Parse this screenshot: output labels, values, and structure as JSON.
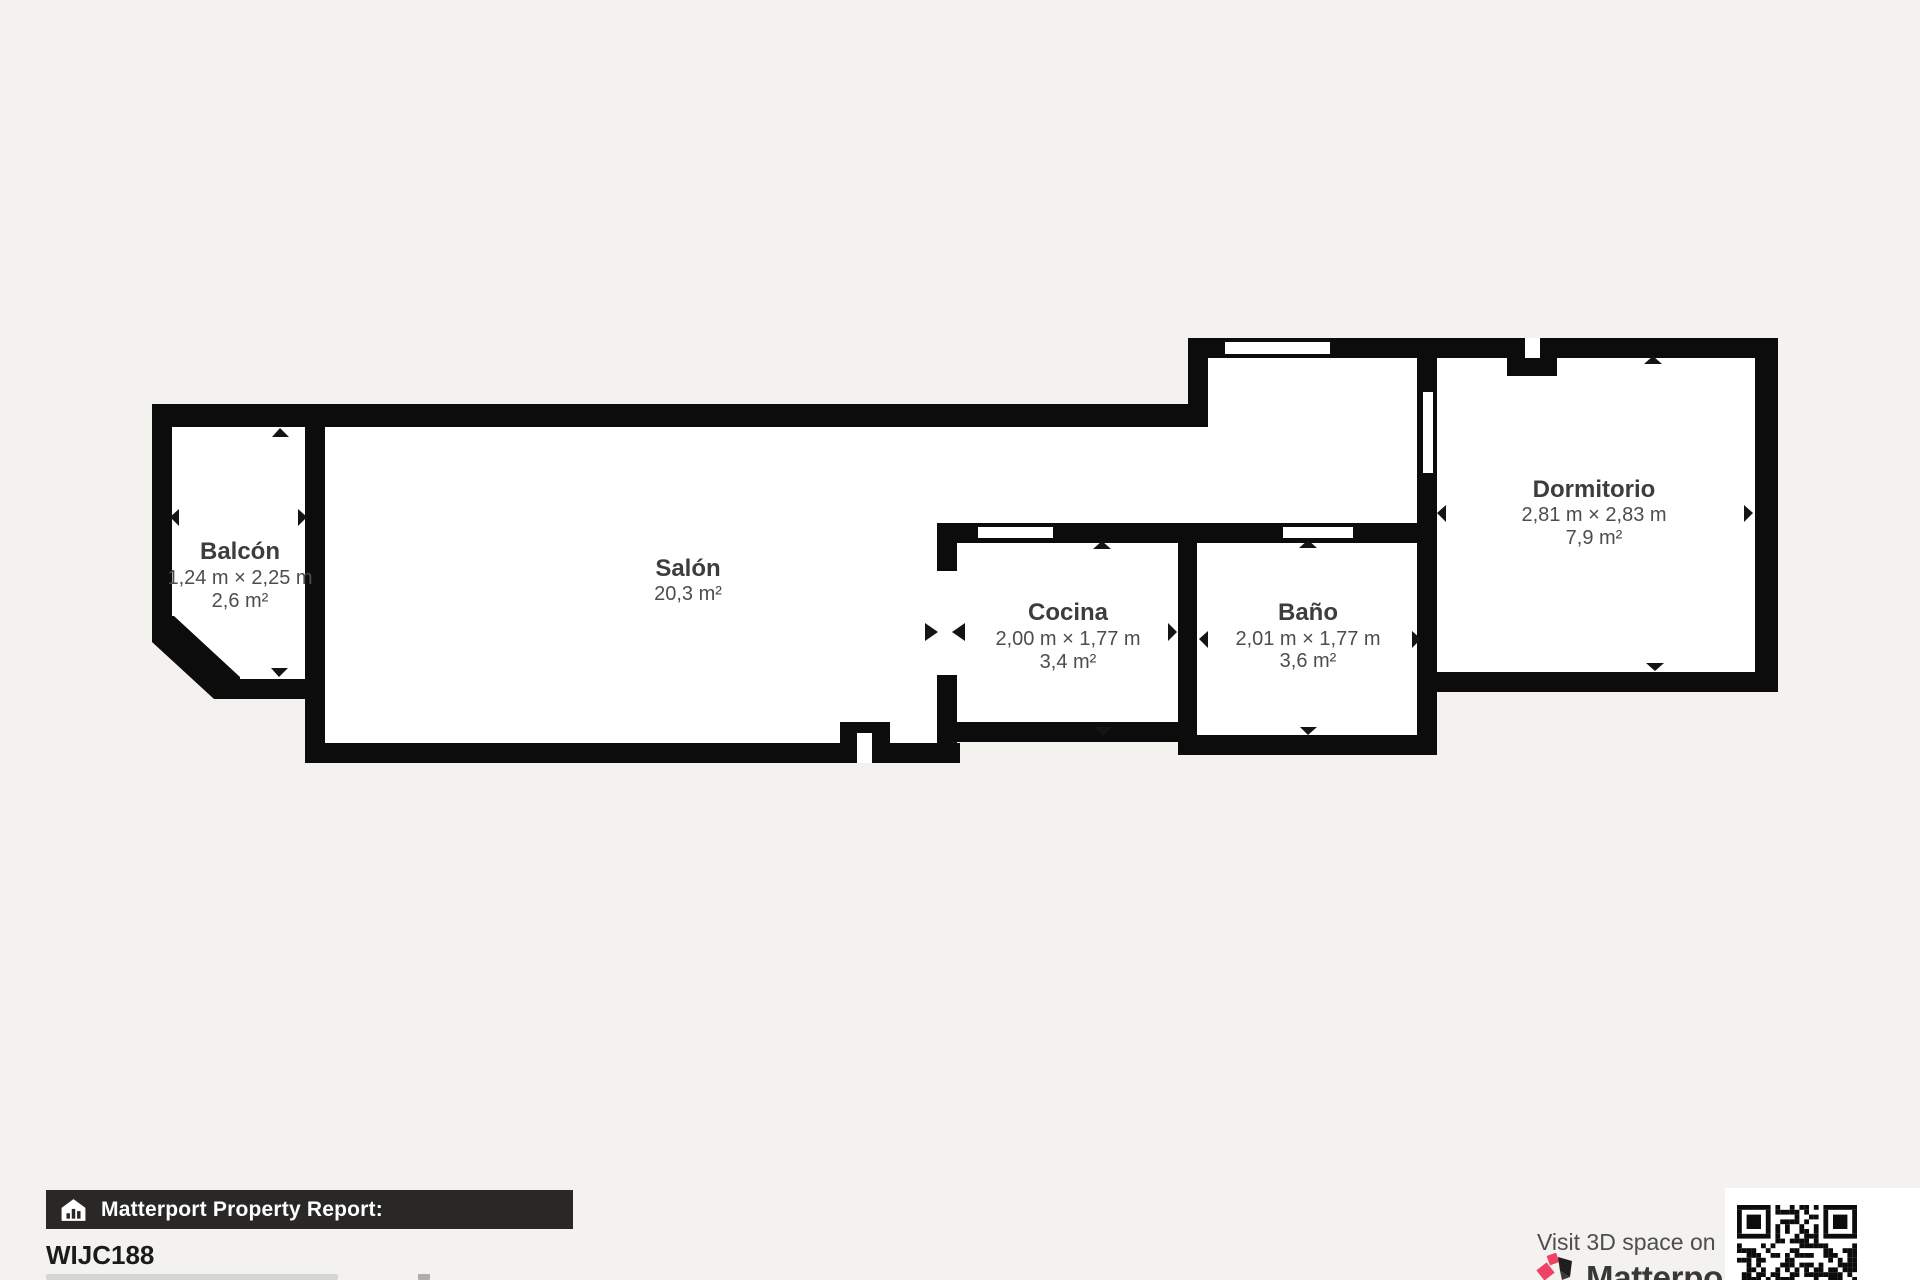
{
  "colors": {
    "background": "#f3f2ef",
    "wall": "#0c0c0c",
    "floor": "#ffffff",
    "brand_pink": "#ee4266",
    "brand_dark": "#1e1e1e",
    "banner_bg": "#292827"
  },
  "rooms": [
    {
      "id": "balcon",
      "name": "Balcón",
      "dimensions": "1,24 m × 2,25 m",
      "area": "2,6 m²"
    },
    {
      "id": "salon",
      "name": "Salón",
      "dimensions": "",
      "area": "20,3 m²"
    },
    {
      "id": "cocina",
      "name": "Cocina",
      "dimensions": "2,00 m × 1,77 m",
      "area": "3,4 m²"
    },
    {
      "id": "bano",
      "name": "Baño",
      "dimensions": "2,01 m × 1,77 m",
      "area": "3,6 m²"
    },
    {
      "id": "dormitorio",
      "name": "Dormitorio",
      "dimensions": "2,81 m × 2,83 m",
      "area": "7,9 m²"
    }
  ],
  "footer": {
    "report_label": "Matterport Property Report:",
    "property_id": "WIJC188"
  },
  "promo": {
    "visit_text": "Visit 3D space on",
    "brand": "Matterport",
    "trademark": "™"
  }
}
